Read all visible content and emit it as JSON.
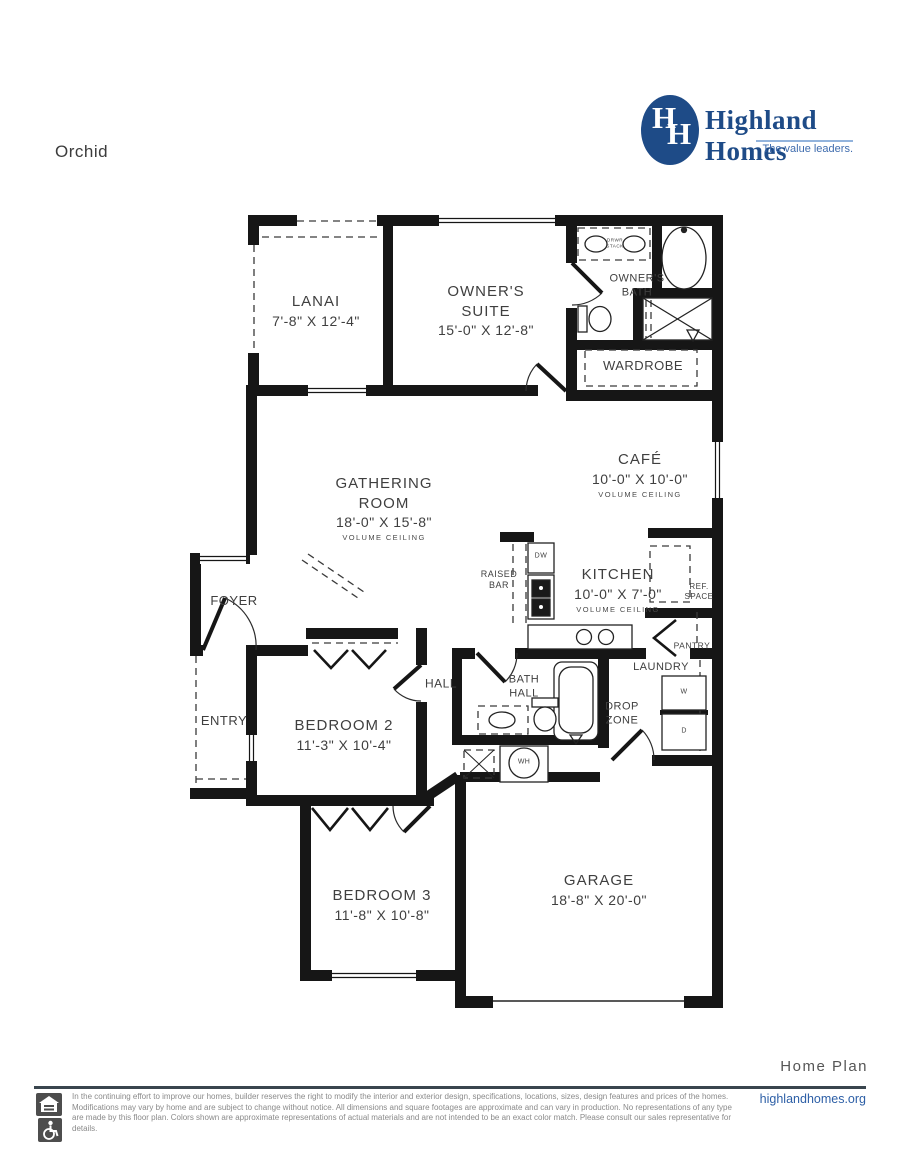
{
  "page": {
    "plan_name": "Orchid",
    "footer_label": "Home Plan",
    "website": "highlandhomes.org",
    "disclaimer": "In the continuing effort to improve our homes, builder reserves the right to modify the interior and exterior design, specifications, locations, sizes, design features and prices of the homes. Modifications may vary by home and are subject to change without notice. All dimensions and square footages are approximate and can vary in production. No representations of any type are made by this floor plan. Colors shown are approximate representations of actual materials and are not intended to be an exact color match. Please consult our sales representative for details."
  },
  "brand": {
    "name": "Highland Homes",
    "tagline": "The value leaders.",
    "monogram_left": "H",
    "monogram_right": "H",
    "color": "#1e4b87"
  },
  "rooms": {
    "lanai": {
      "name": "LANAI",
      "dims": "7'-8\" X 12'-4\""
    },
    "owners_suite": {
      "name": "OWNER'S SUITE",
      "dims": "15'-0\" X 12'-8\""
    },
    "owners_bath": {
      "name": "OWNER'S BATH"
    },
    "wardrobe": {
      "name": "WARDROBE"
    },
    "gathering_room": {
      "name": "GATHERING ROOM",
      "dims": "18'-0\" X 15'-8\"",
      "note": "VOLUME CEILING"
    },
    "cafe": {
      "name": "CAFÉ",
      "dims": "10'-0\" X 10'-0\"",
      "note": "VOLUME CEILING"
    },
    "kitchen": {
      "name": "KITCHEN",
      "dims": "10'-0\" X 7'-0\"",
      "note": "VOLUME CEILING"
    },
    "foyer": {
      "name": "FOYER"
    },
    "entry": {
      "name": "ENTRY"
    },
    "bedroom2": {
      "name": "BEDROOM 2",
      "dims": "11'-3\" X 10'-4\""
    },
    "hall": {
      "name": "HALL"
    },
    "hall_bath": {
      "name": "BATH HALL"
    },
    "drop_zone": {
      "name": "DROP ZONE"
    },
    "laundry": {
      "name": "LAUNDRY"
    },
    "pantry": {
      "name": "PANTRY"
    },
    "bedroom3": {
      "name": "BEDROOM 3",
      "dims": "11'-8\" X 10'-8\""
    },
    "garage": {
      "name": "GARAGE",
      "dims": "18'-8\" X 20'-0\""
    }
  },
  "annotations": {
    "raised_bar": "RAISED BAR",
    "dishwasher": "DW",
    "ref_space": "REF. SPACE",
    "drawer_stack": "DRWR STACK",
    "washer": "W",
    "dryer": "D",
    "water_heater": "WH"
  }
}
